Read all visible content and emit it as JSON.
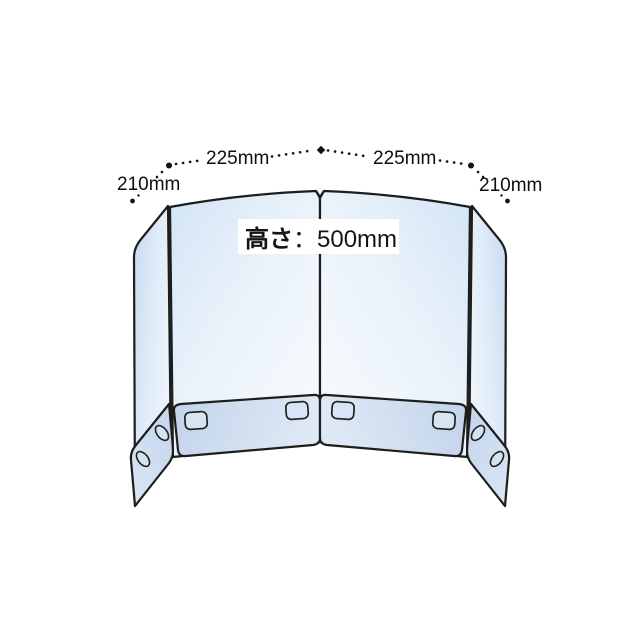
{
  "diagram": {
    "title": "folding-partition-product-diagram",
    "dimensions": {
      "left_wing_width": "210mm",
      "left_panel_width": "225mm",
      "right_panel_width": "225mm",
      "right_wing_width": "210mm",
      "height_prefix": "高さ",
      "height_value": "：500mm"
    },
    "colors": {
      "background": "#ffffff",
      "panel_blue_light": "#f7fbfe",
      "panel_blue": "#d3e4f5",
      "wing_blue": "#cddff2",
      "flap_blue_dark": "#c2d3ea",
      "flap_blue_light": "#dfe9f6",
      "slot_fill": "#d8e5f4",
      "outline": "#1d1d1b",
      "label_text": "#0e0e0e"
    },
    "parts": {
      "left_wing": "wing-panel",
      "left_center": "center-panel",
      "right_center": "center-panel",
      "right_wing": "wing-panel",
      "base_flaps": 4,
      "tab_slots": 8
    }
  }
}
